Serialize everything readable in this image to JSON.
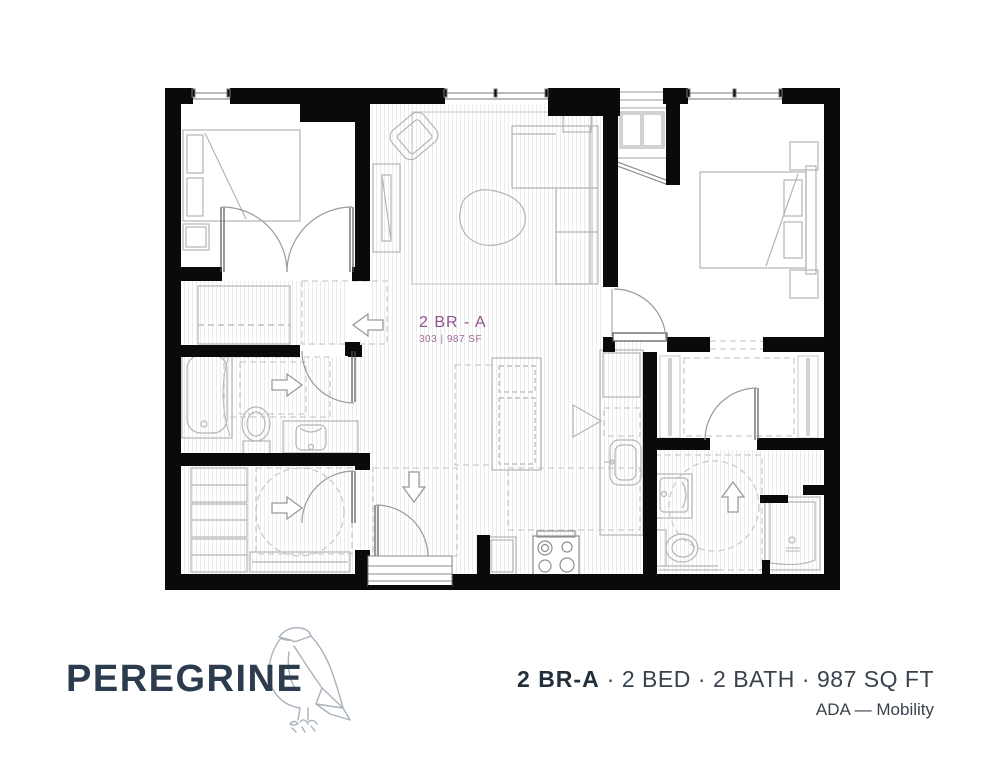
{
  "floor_plan": {
    "unit_label": "2 BR - A",
    "unit_meta": "303 | 987 SF",
    "label_color": "#91508d",
    "route_arrow_directions": [
      "left",
      "right",
      "right",
      "down",
      "up"
    ],
    "features": [
      "2 bedrooms",
      "2 bathrooms",
      "kitchen island",
      "stacked washer dryer",
      "entry steps",
      "ADA turning circles"
    ]
  },
  "footer": {
    "brand": "PEREGRINE",
    "logo_icon": "falcon-line-icon",
    "unit_name": "2 BR-A",
    "separator": "·",
    "specs": [
      "2 BED",
      "2 BATH",
      "987 SQ FT"
    ],
    "ada_note": "ADA — Mobility"
  },
  "colors": {
    "wall": "#0a0a0a",
    "brand_navy": "#2c3b4e",
    "body_text": "#39434e",
    "accent_purple": "#91508d",
    "furniture_line": "#b5b5b5",
    "dashed_line": "#c2c2c2",
    "floor_hatch": "#ebebeb"
  }
}
